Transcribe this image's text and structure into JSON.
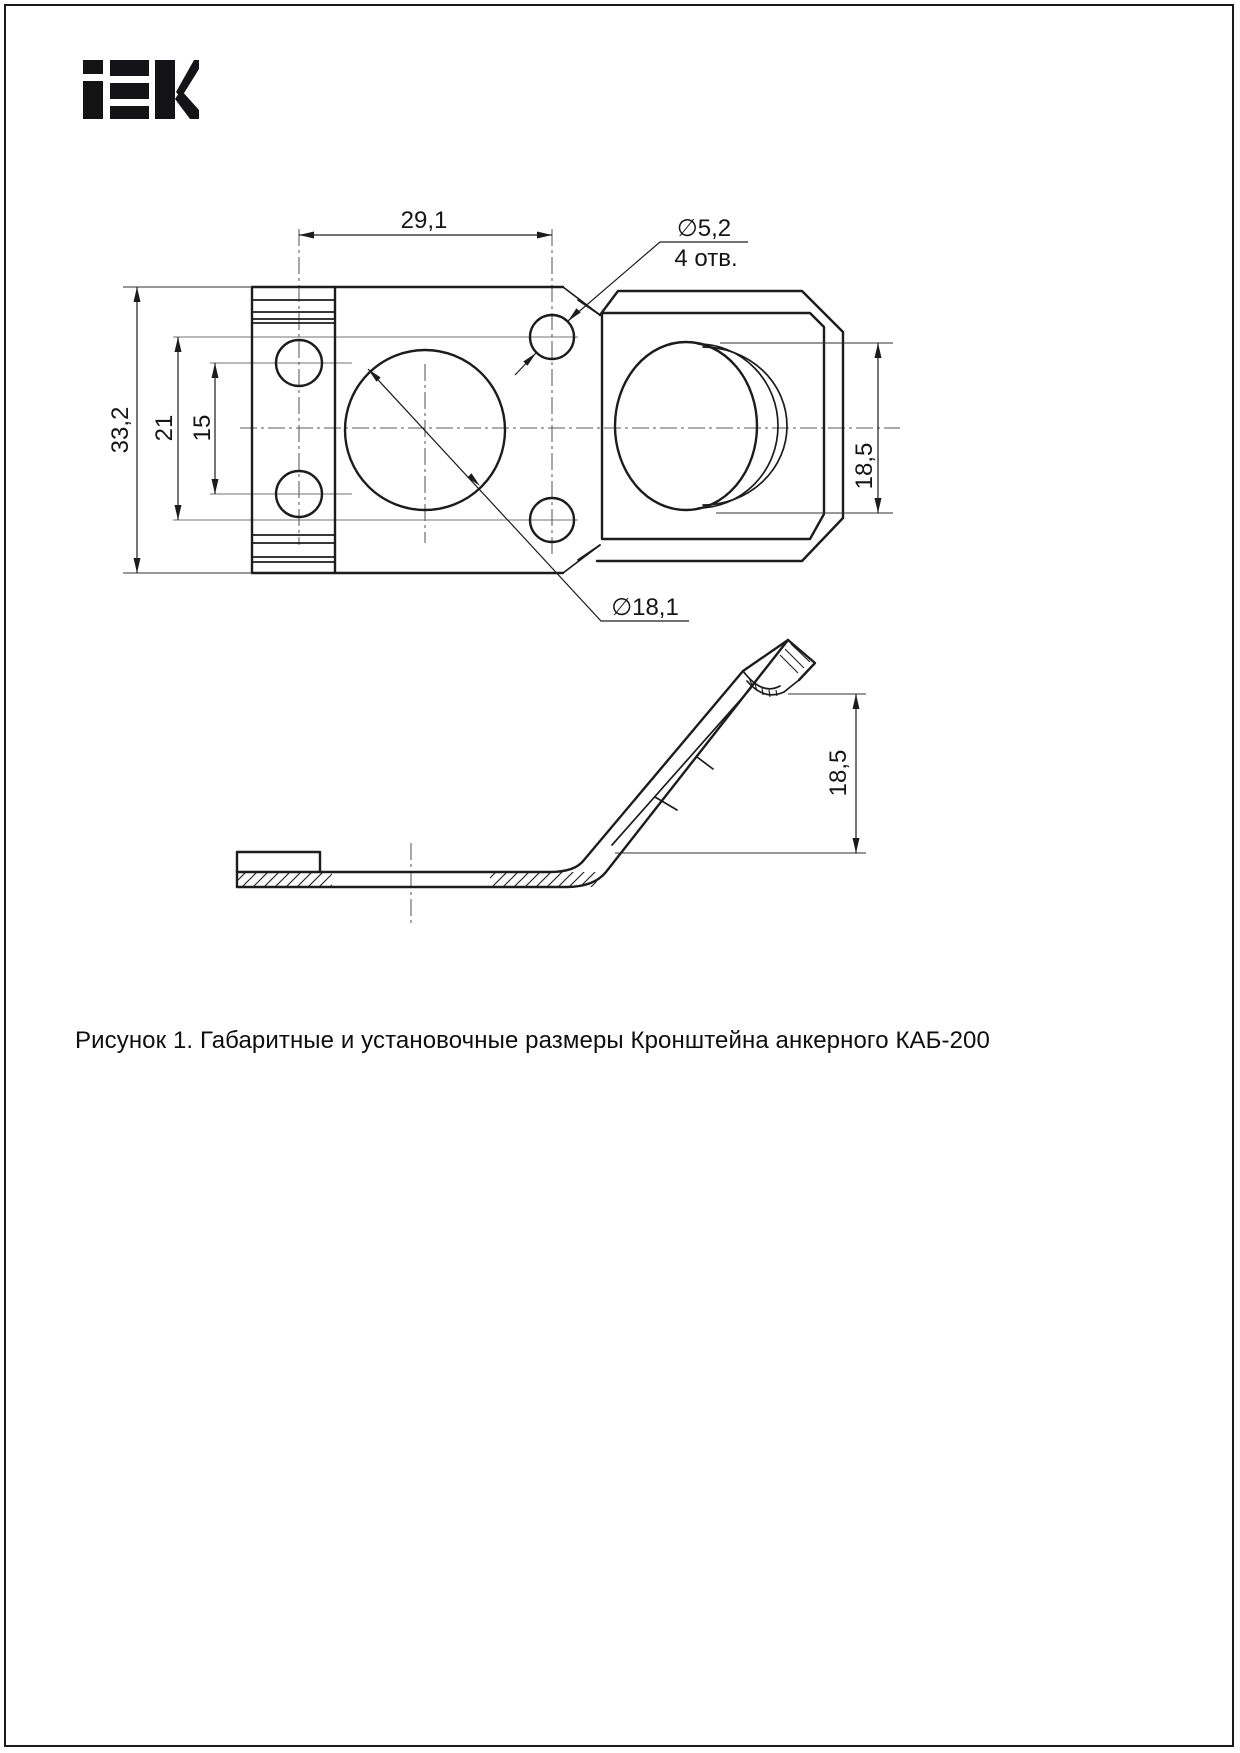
{
  "logo": {
    "brand": "IEK"
  },
  "caption": "Рисунок 1. Габаритные и установочные размеры Кронштейна анкерного КАБ-200",
  "labels": {
    "dim_width_holes": "29,1",
    "dim_small_hole_dia": "∅5,2",
    "dim_small_hole_count": "4 отв.",
    "dim_overall_height": "33,2",
    "dim_right_holes_spacing": "21",
    "dim_left_holes_spacing": "15",
    "dim_saddle_height_front": "18,5",
    "dim_big_hole_dia": "∅18,1",
    "dim_saddle_height_side": "18,5"
  },
  "colors": {
    "line": "#1c1c1c",
    "aux_line": "#8f8f8f",
    "background": "#ffffff"
  }
}
